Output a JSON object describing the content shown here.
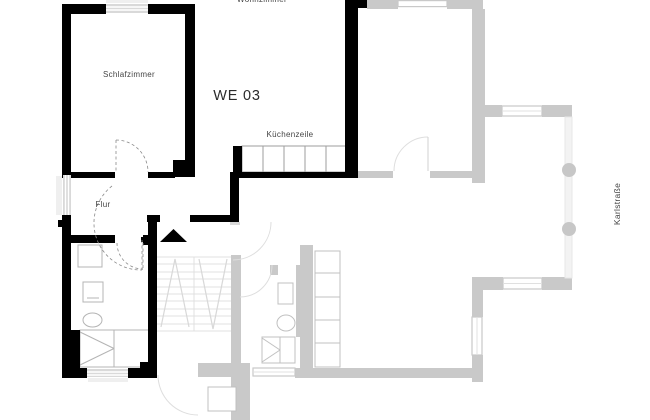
{
  "floorplan": {
    "unit_label": "WE 03",
    "rooms": {
      "wohnzimmer": "Wohnzimmer",
      "schlafzimmer": "Schlafzimmer",
      "kuechenzeile": "Küchenzeile",
      "flur": "Flur"
    },
    "street_label": "Karlstraße",
    "colors": {
      "background": "#ffffff",
      "unit_wall": "#000000",
      "neighbor_wall": "#c9c9c9",
      "window_band": "#d9d9d9",
      "window_sill": "#efefef",
      "railing": "#e7e7e7",
      "balcony_column": "#c7c7c7",
      "fixture_outline": "#b4b4b4",
      "stair_lines": "#e0e0e0",
      "door_arc_unit": "#8a8a8a",
      "door_arc_neighbor": "#dedede",
      "label_text": "#444444",
      "unit_label_text": "#2b2b2b"
    }
  }
}
